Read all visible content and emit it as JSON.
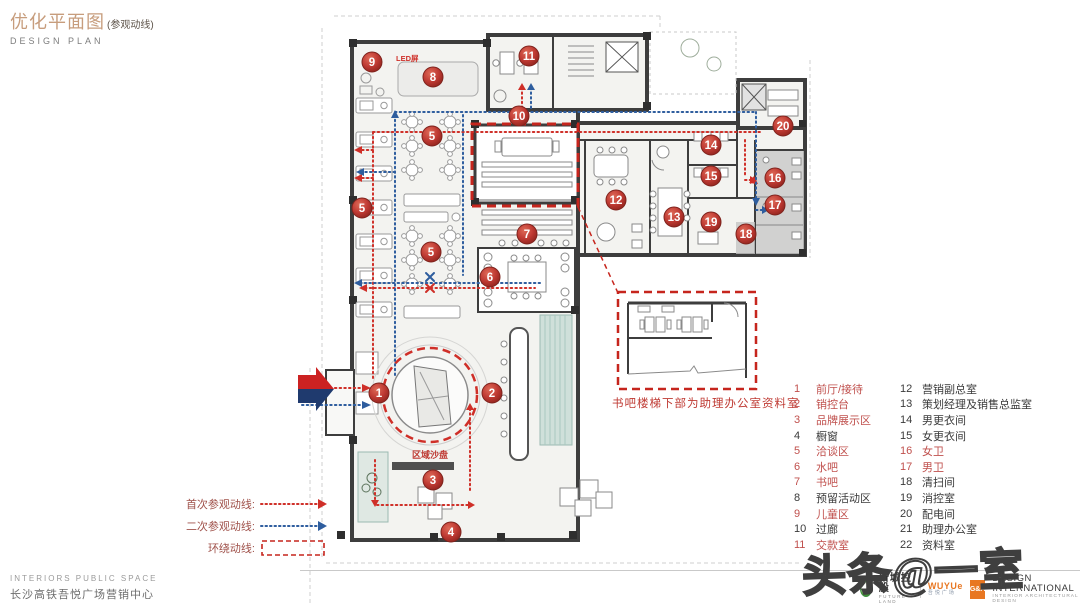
{
  "title": {
    "cn": "优化平面图",
    "sub": "(参观动线)",
    "en": "DESIGN  PLAN"
  },
  "colors": {
    "title_tan": "#c79d7d",
    "route_red": "#cf2f28",
    "route_blue": "#2e5d9e",
    "marker_red": "#bf3a33",
    "legend_red": "#c0504d",
    "legend_black": "#3a3a3a",
    "wall": "#3d3d3d"
  },
  "plan": {
    "led_label": "LED屏",
    "sand_table_label": "区域沙盘",
    "inset_caption": "书吧楼梯下部为助理办公室资料室",
    "markers": [
      {
        "n": "1",
        "x": 379,
        "y": 393
      },
      {
        "n": "2",
        "x": 492,
        "y": 393
      },
      {
        "n": "3",
        "x": 433,
        "y": 480
      },
      {
        "n": "4",
        "x": 451,
        "y": 532
      },
      {
        "n": "5",
        "x": 432,
        "y": 136
      },
      {
        "n": "5",
        "x": 362,
        "y": 208
      },
      {
        "n": "5",
        "x": 431,
        "y": 252
      },
      {
        "n": "6",
        "x": 490,
        "y": 277
      },
      {
        "n": "7",
        "x": 527,
        "y": 234
      },
      {
        "n": "8",
        "x": 433,
        "y": 77
      },
      {
        "n": "9",
        "x": 372,
        "y": 62
      },
      {
        "n": "10",
        "x": 519,
        "y": 116
      },
      {
        "n": "11",
        "x": 529,
        "y": 56
      },
      {
        "n": "12",
        "x": 616,
        "y": 200
      },
      {
        "n": "13",
        "x": 674,
        "y": 217
      },
      {
        "n": "14",
        "x": 711,
        "y": 145
      },
      {
        "n": "15",
        "x": 711,
        "y": 176
      },
      {
        "n": "16",
        "x": 775,
        "y": 178
      },
      {
        "n": "17",
        "x": 775,
        "y": 205
      },
      {
        "n": "18",
        "x": 746,
        "y": 234
      },
      {
        "n": "19",
        "x": 711,
        "y": 222
      },
      {
        "n": "20",
        "x": 783,
        "y": 126
      }
    ]
  },
  "route_legend": [
    {
      "label": "首次参观动线:",
      "type": "red-dotted-arrow"
    },
    {
      "label": "二次参观动线:",
      "type": "blue-dotted-arrow"
    },
    {
      "label": "环绕动线:",
      "type": "red-dashed-box"
    }
  ],
  "room_legend": {
    "col1": [
      {
        "num": "1",
        "label": "前厅/接待",
        "red": true
      },
      {
        "num": "2",
        "label": "销控台",
        "red": true
      },
      {
        "num": "3",
        "label": "品牌展示区",
        "red": true
      },
      {
        "num": "4",
        "label": "橱窗",
        "red": false
      },
      {
        "num": "5",
        "label": "洽谈区",
        "red": true
      },
      {
        "num": "6",
        "label": "水吧",
        "red": true
      },
      {
        "num": "7",
        "label": "书吧",
        "red": true
      },
      {
        "num": "8",
        "label": "预留活动区",
        "red": false
      },
      {
        "num": "9",
        "label": "儿童区",
        "red": true
      },
      {
        "num": "10",
        "label": "过廊",
        "red": false
      },
      {
        "num": "11",
        "label": "交款室",
        "red": true
      }
    ],
    "col2": [
      {
        "num": "12",
        "label": "营销副总室",
        "red": false
      },
      {
        "num": "13",
        "label": "策划经理及销售总监室",
        "red": false
      },
      {
        "num": "14",
        "label": "男更衣间",
        "red": false
      },
      {
        "num": "15",
        "label": "女更衣间",
        "red": false
      },
      {
        "num": "16",
        "label": "女卫",
        "red": true
      },
      {
        "num": "17",
        "label": "男卫",
        "red": true
      },
      {
        "num": "18",
        "label": "清扫间",
        "red": false
      },
      {
        "num": "19",
        "label": "消控室",
        "red": false
      },
      {
        "num": "20",
        "label": "配电间",
        "red": false
      },
      {
        "num": "21",
        "label": "助理办公室",
        "red": false
      },
      {
        "num": "22",
        "label": "资料室",
        "red": false
      }
    ]
  },
  "footer": {
    "en": "INTERIORS  PUBLIC  SPACE",
    "cn": "长沙高铁吾悦广场营销中心",
    "logo1_cn": "新城控股",
    "logo1_en": "FUTURE LAND",
    "logo2_en": "WUYUe",
    "logo2_cn": "吾悦广场",
    "logo3": "G&A",
    "logo4_line1": "DESIGN INTERNATIONAL",
    "logo4_line2": "INTERIOR ARCHITECTURAL DESIGN"
  },
  "watermark": "头条@一室"
}
